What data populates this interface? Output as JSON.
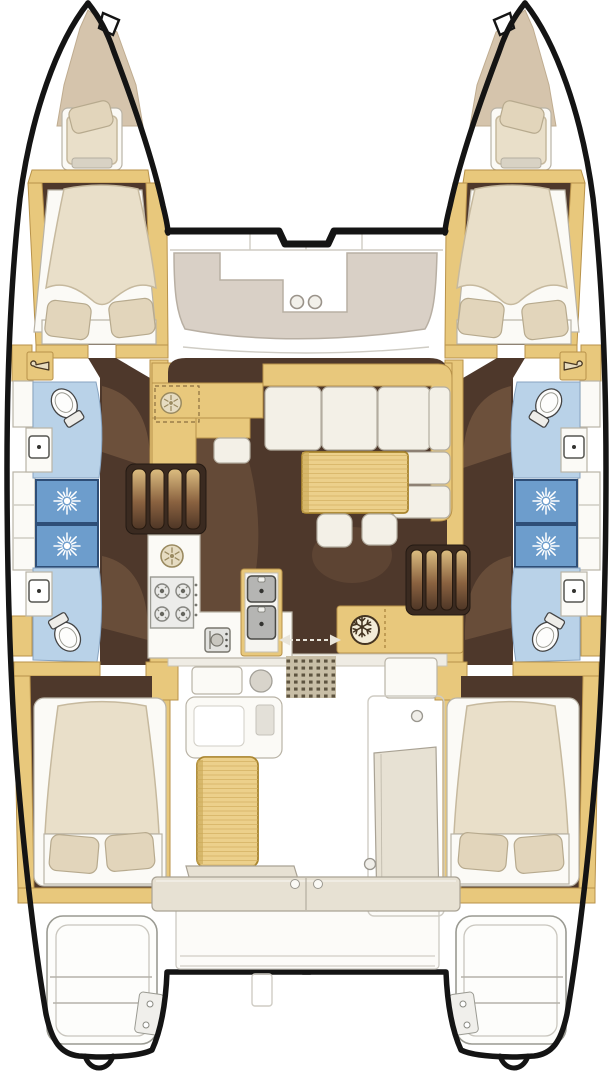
{
  "diagram": {
    "type": "catamaran yacht interior floor plan, top-down view",
    "hulls": 2,
    "orientation": "bow at top, stern at bottom"
  },
  "colors": {
    "hull_outline": "#141414",
    "wood": "#e8c87c",
    "wood_edge": "#b8924a",
    "floor_dark": "#4e382b",
    "floor_shadow": "#8a684c",
    "mattress": "#e9dfc9",
    "mattress_edge": "#c6b99e",
    "pillow": "#e2d5bb",
    "pillow_edge": "#b7aa8e",
    "white_base": "#fbfaf6",
    "gray_edge": "#b9b3a6",
    "cushion": "#f3f0e7",
    "cushion_edge": "#b3ada0",
    "sunpad": "#d9d0c6",
    "sunpad_edge": "#b8afa3",
    "bow_pad": "#d5c4ac",
    "bow_pad_edge": "#bfac90",
    "bathroom_blue": "#b9d2e8",
    "bathroom_edge": "#87a3c0",
    "shower_blue": "#6d9dcc",
    "shower_edge": "#2e4e77",
    "table_wood": "#ecd08b",
    "table_grain": "#d2af60",
    "table_edge": "#a8842e",
    "bench": "#e7e1d3",
    "bench_edge": "#a9a294",
    "mat": "#c8bea6",
    "mat_dot": "#5e5440",
    "icon_dark": "#443421",
    "steel": "#b5b5b3",
    "steel_edge": "#4a4a46",
    "thin_line": "#cfccc4"
  },
  "areas": {
    "foredeck": {
      "features": [
        "port bow sun pad",
        "starboard bow sun pad",
        "forward lounge pad with cup holders",
        "front crossbeam"
      ],
      "cupholders": 2
    },
    "bows": {
      "forepeak_berths": 2
    },
    "port_hull": {
      "forward_cabin": "double bed, 2 pillows",
      "forward_bathroom": "toilet + sink",
      "shower_stalls": 2,
      "aft_bathroom": "toilet + sink",
      "aft_cabin": "double bed, 2 pillows",
      "wardrobes": 2
    },
    "starboard_hull": {
      "forward_cabin": "double bed, 2 pillows",
      "forward_bathroom": "toilet + sink",
      "shower_stalls": 2,
      "aft_bathroom": "toilet + sink",
      "aft_cabin": "double bed, 2 pillows",
      "wardrobes": 2
    },
    "saloon": {
      "galley": [
        "forward counter with optional round sink (dashed)",
        "round spoke sink",
        "4-burner stove",
        "oven",
        "double-sink island",
        "refrigerator with snowflake mark"
      ],
      "dinette": [
        "L-shaped sofa",
        "rectangular wood table",
        "2 stools"
      ],
      "stairs": [
        "port staircase to hull",
        "starboard staircase to hull"
      ],
      "aft": [
        "sliding door with arrows",
        "dotted entry mat"
      ]
    },
    "cockpit": {
      "features": [
        "side console",
        "wood cockpit table",
        "corner bench",
        "starboard bench",
        "aft bench",
        "aft platform"
      ]
    },
    "transoms": {
      "swim_step_platforms": 2,
      "davit_hooks": 2
    }
  },
  "fixtures": {
    "toilets": 4,
    "bathroom_sinks": 4,
    "shower_stalls": 4,
    "galley_burners": 4,
    "galley_sinks": 2,
    "double_beds": 4,
    "forepeak_berths": 2,
    "wardrobes": 4,
    "staircases": 2,
    "stools": 2,
    "tables": 2,
    "cupholders": 2
  },
  "icons": [
    "shower-head-icon",
    "toilet-icon",
    "hanger-icon",
    "snowflake-icon",
    "burner-icon",
    "round-sink-icon",
    "double-sink-icon",
    "oven-icon",
    "slide-arrows-icon",
    "cupholder-icon"
  ]
}
